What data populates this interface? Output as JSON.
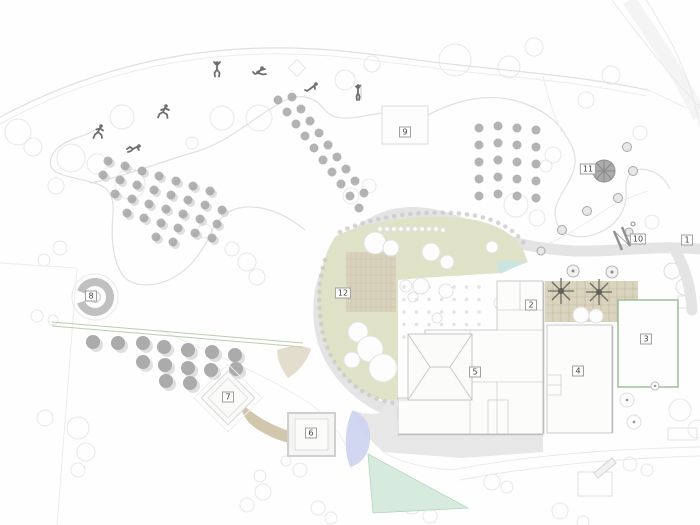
{
  "plan": {
    "markers": [
      {
        "label": "1"
      },
      {
        "label": "2"
      },
      {
        "label": "3"
      },
      {
        "label": "4"
      },
      {
        "label": "5"
      },
      {
        "label": "6"
      },
      {
        "label": "7"
      },
      {
        "label": "8"
      },
      {
        "label": "9"
      },
      {
        "label": "10"
      },
      {
        "label": "11"
      },
      {
        "label": "12"
      }
    ]
  },
  "colors": {
    "olive-garden": "#dfe2c6",
    "terrace-beige": "#d8d2bc",
    "tan-path": "#c9bd9f",
    "road-gray": "#e4e4e4",
    "court-green": "#9cbf97",
    "pond-blue": "#ccd3ee",
    "water-teal": "#d4e9dd",
    "allee-green": "#b9cfaf",
    "tree-dark": "#a6a6a6",
    "figure-gray": "#6f6f6f",
    "line-light": "#e0e0e0",
    "marker-border": "#9f9f9f",
    "marker-text": "#3f3f3f"
  }
}
